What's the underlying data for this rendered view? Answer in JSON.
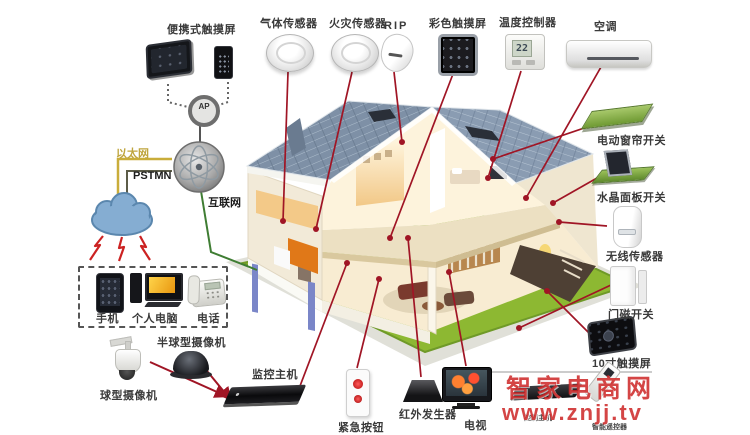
{
  "title": "智能家居系统图",
  "labels": {
    "portable_touchscreen": "便携式触摸屏",
    "gas_sensor": "气体传感器",
    "fire_sensor": "火灾传感器",
    "pir": "RIP",
    "color_touchscreen": "彩色触摸屏",
    "temperature_controller": "温度控制器",
    "air_conditioner": "空调",
    "curtain_switch": "电动窗帘开关",
    "crystal_panel_switch": "水晶面板开关",
    "wireless_sensor": "无线传感器",
    "door_magnet_switch": "门磁开关",
    "touchscreen_10inch": "10寸触摸屏",
    "monitor_host": "监控主机",
    "emergency_button": "紧急按钮",
    "ir_generator": "红外发生器",
    "tv": "电视",
    "ball_camera": "球型摄像机",
    "dome_camera": "半球型摄像机",
    "mobile_phone": "手机",
    "personal_computer": "个人电脑",
    "telephone": "电话",
    "control_host": "控制主机",
    "smart_remote": "智能遥控器"
  },
  "network": {
    "ap": "AP",
    "ethernet": "以太网",
    "pstn": "PSTMN",
    "internet": "互联网"
  },
  "temp_display": "22",
  "watermark": {
    "brand": "智家电商网",
    "url": "www.znjj.tv"
  },
  "colors": {
    "connection_line": "#a01525",
    "ethernet_label": "#bfa53e",
    "lawn_green": "#8db832",
    "roof_blue": "#7e90a6",
    "watermark_red": "#cc2424"
  }
}
